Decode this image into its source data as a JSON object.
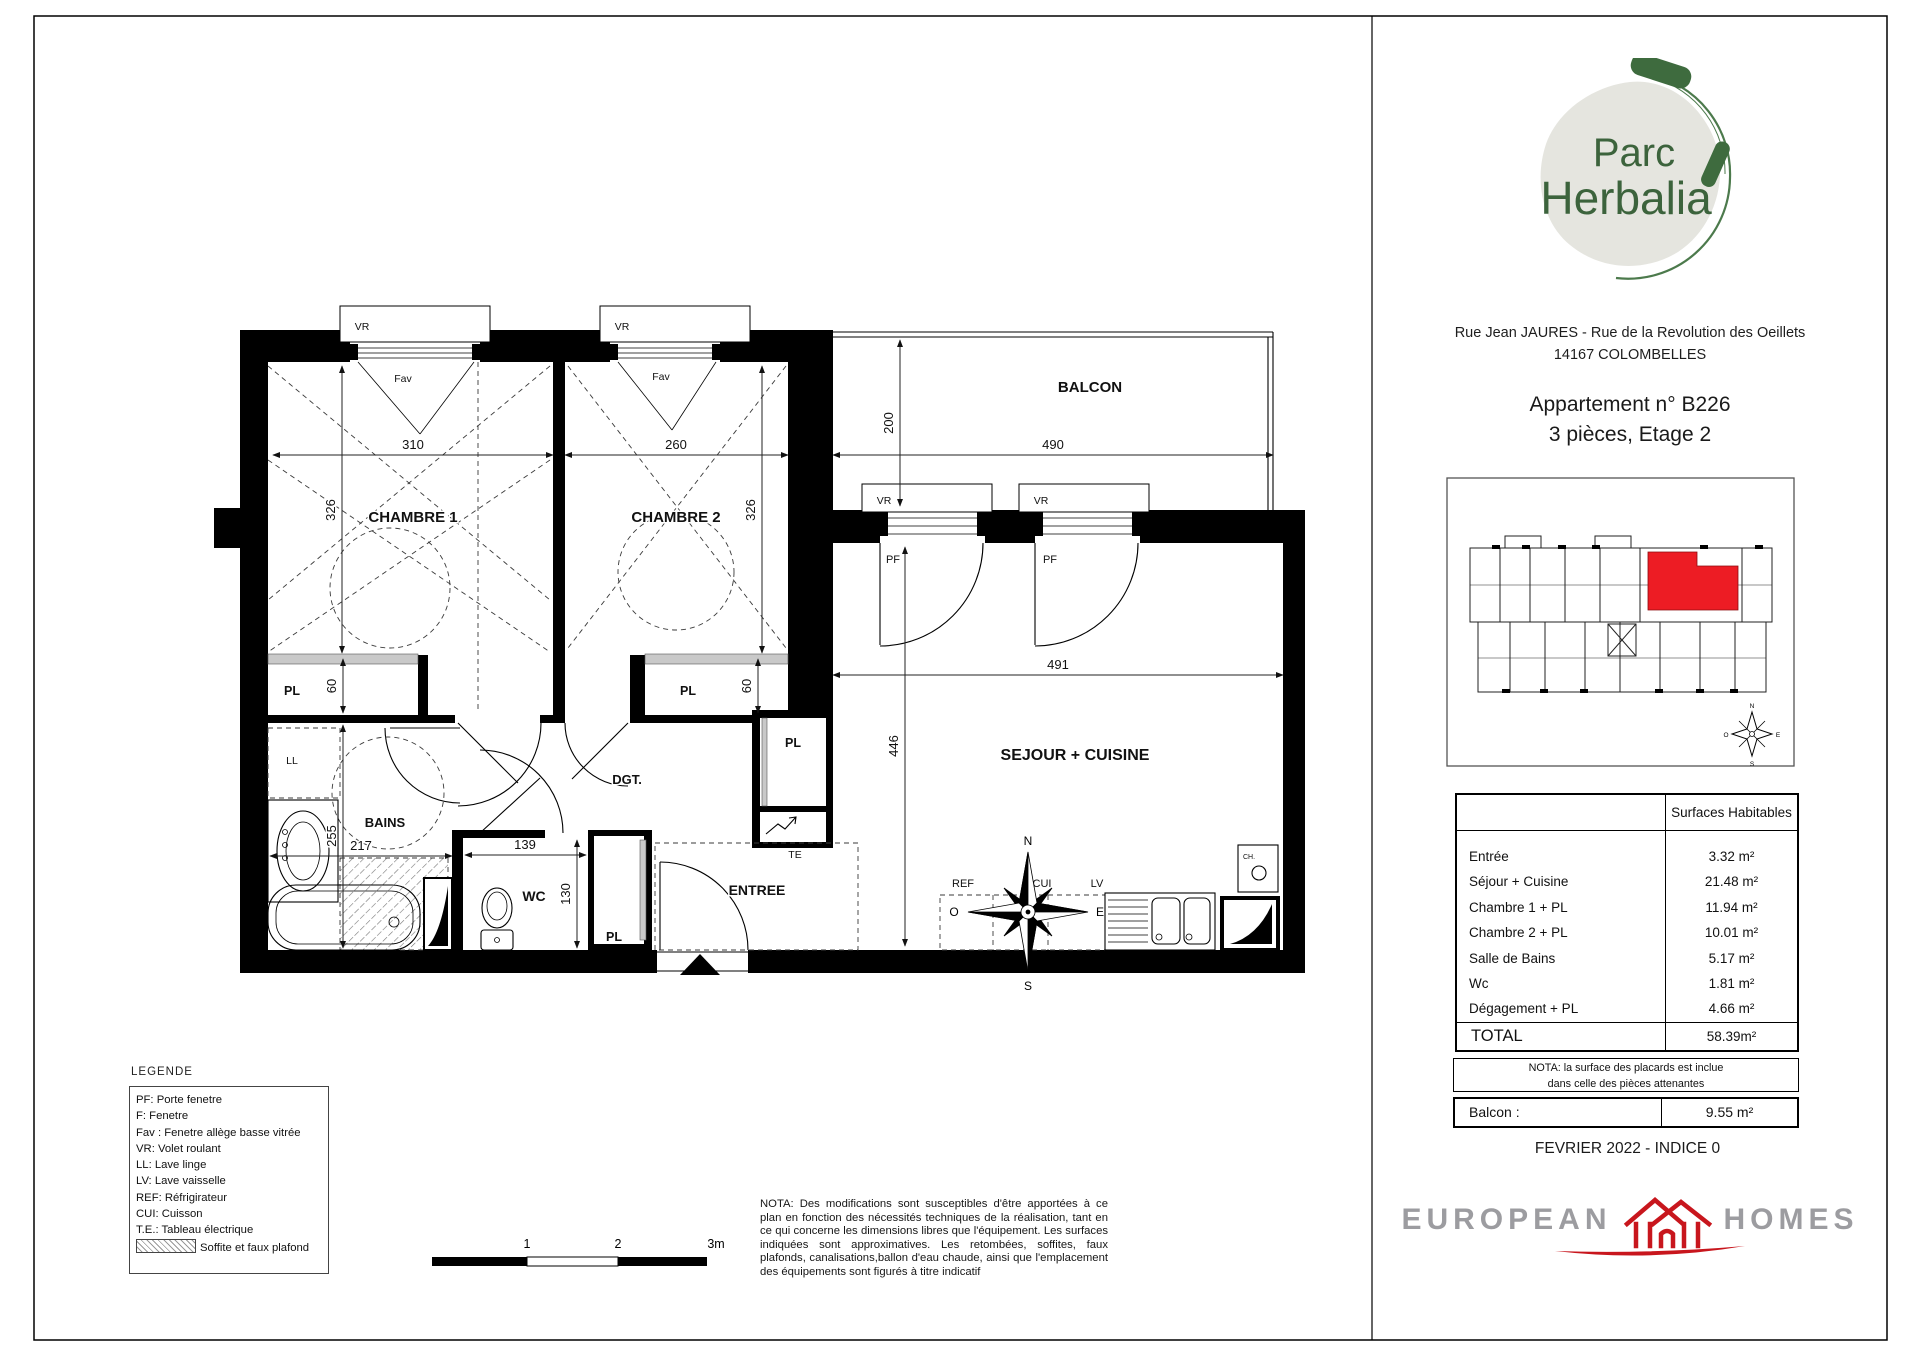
{
  "doc": {
    "address_line1": "Rue Jean JAURES - Rue de la Revolution des Oeillets",
    "address_line2": "14167 COLOMBELLES",
    "apartment_line1": "Appartement n° B226",
    "apartment_line2": "3 pièces, Etage 2",
    "date_line": "FEVRIER 2022 - INDICE 0"
  },
  "logo": {
    "word1": "Parc",
    "word2": "Herbalia"
  },
  "brand": {
    "left": "EUROPEAN",
    "right": "HOMES"
  },
  "plan": {
    "rooms": {
      "chambre1": "CHAMBRE 1",
      "chambre2": "CHAMBRE 2",
      "balcon": "BALCON",
      "sejour": "SEJOUR + CUISINE",
      "bains": "BAINS",
      "wc": "WC",
      "dgt": "DGT.",
      "entree": "ENTREE"
    },
    "dims": {
      "c1_w": "310",
      "c1_h": "326",
      "c2_w": "260",
      "c2_h": "326",
      "balcon_d": "200",
      "balcon_w": "490",
      "sejour_w": "491",
      "sejour_h": "446",
      "pl1": "60",
      "pl2": "60",
      "bains_h": "255",
      "bains_w": "217",
      "wc_w": "139",
      "wc_h": "130"
    },
    "tags": {
      "vr": "VR",
      "fav": "Fav",
      "pf": "PF",
      "pl": "PL",
      "ll": "LL",
      "ref": "REF",
      "cui": "CUI",
      "lv": "LV",
      "te": "TE",
      "ch": "CH."
    },
    "compass": {
      "n": "N",
      "e": "E",
      "s": "S",
      "o": "O"
    },
    "scalebar": {
      "l1": "1",
      "l2": "2",
      "l3": "3m"
    }
  },
  "legend": {
    "title": "LEGENDE",
    "items": [
      "PF: Porte fenetre",
      "F: Fenetre",
      "Fav : Fenetre allège basse vitrée",
      "VR: Volet roulant",
      "LL: Lave linge",
      "LV: Lave vaisselle",
      "REF: Réfrigirateur",
      "CUI: Cuisson",
      "T.E.: Tableau électrique"
    ],
    "swatch_label": "Soffite et faux plafond"
  },
  "nota_main": "NOTA:  Des modifications sont susceptibles d'être apportées à ce plan en fonction des nécessités techniques de la réalisation, tant en ce qui concerne les dimensions libres que l'équipement. Les surfaces indiquées sont approximatives. Les retombées, soffites, faux plafonds, canalisations,ballon d'eau chaude, ainsi que l'emplacement des équipements sont figurés à titre indicatif",
  "table": {
    "header": "Surfaces Habitables",
    "rows": [
      {
        "label": "Entrée",
        "value": "3.32 m²"
      },
      {
        "label": "Séjour + Cuisine",
        "value": "21.48 m²"
      },
      {
        "label": "Chambre 1 + PL",
        "value": "11.94 m²"
      },
      {
        "label": "Chambre 2 + PL",
        "value": "10.01 m²"
      },
      {
        "label": "Salle de Bains",
        "value": "5.17 m²"
      },
      {
        "label": "Wc",
        "value": "1.81 m²"
      },
      {
        "label": "Dégagement + PL",
        "value": "4.66 m²"
      }
    ],
    "total_label": "TOTAL",
    "total_value": "58.39m²",
    "nota_line1": "NOTA: la surface des placards est inclue",
    "nota_line2": "dans celle des pièces attenantes",
    "balcon_label": "Balcon :",
    "balcon_value": "9.55 m²"
  },
  "colors": {
    "highlight_red": "#ed1c24",
    "brand_red": "#c8161d",
    "brand_gray": "#9c9ca0",
    "logo_green": "#41673f",
    "logo_blob": "#e5e5df"
  }
}
